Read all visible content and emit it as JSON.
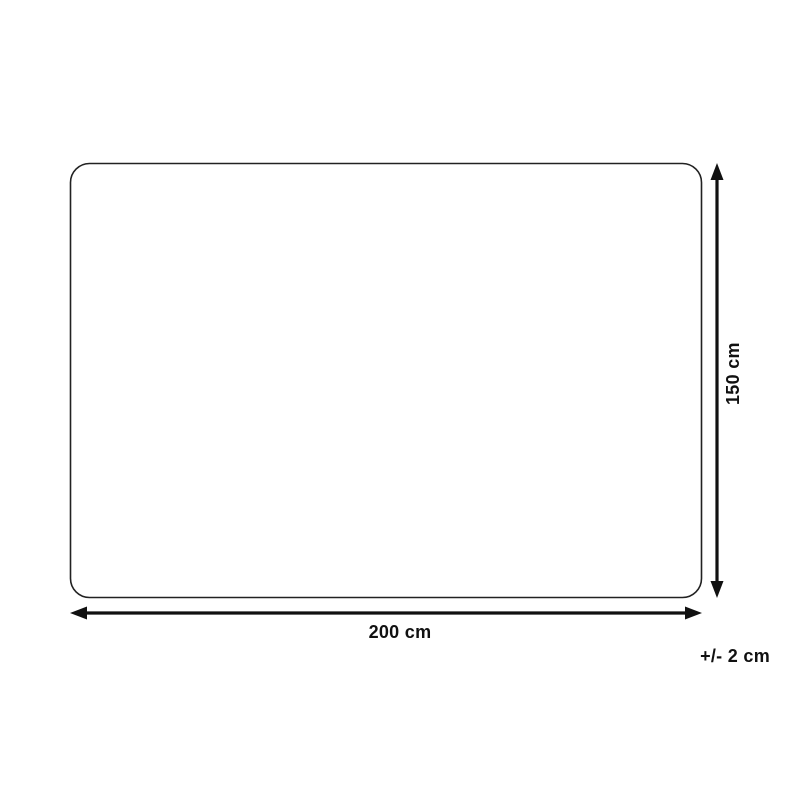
{
  "diagram": {
    "type": "product-dimension-diagram",
    "width_label": "200 cm",
    "height_label": "150 cm",
    "tolerance_label": "+/- 2 cm",
    "width_cm": 200,
    "height_cm": 150,
    "tolerance_cm": 2,
    "outline_color": "#222222",
    "line_color": "#111111",
    "background_color": "#ffffff"
  }
}
